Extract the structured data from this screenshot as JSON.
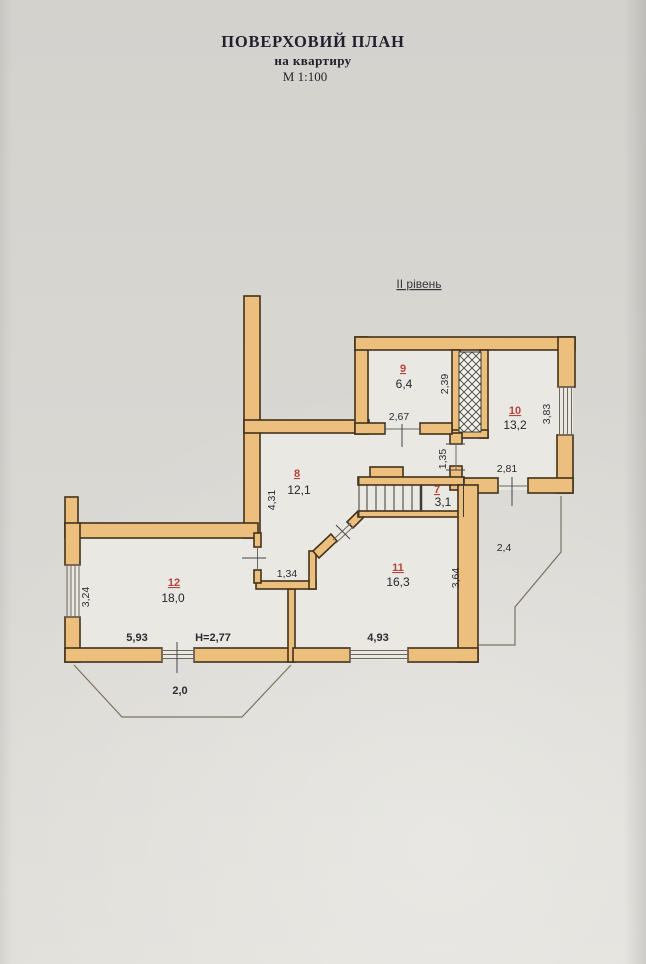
{
  "colors": {
    "paper": "#dad8d3",
    "floor": "#eae8e2",
    "wall_fill": "#ecc07c",
    "wall_stroke": "#42311d",
    "room_number_red": "#b5443c",
    "dim_text": "#2c2b33",
    "height_blue": "#2150b4",
    "title_ink": "#201f2b"
  },
  "title": {
    "line1": "ПОВЕРХОВИЙ ПЛАН",
    "line2": "на квартиру",
    "line3": "М 1:100"
  },
  "level_label": "ІІ рівень",
  "rooms": [
    {
      "number": "9",
      "area": "6,4"
    },
    {
      "number": "10",
      "area": "13,2"
    },
    {
      "number": "8",
      "area": "12,1"
    },
    {
      "number": "7",
      "area": "3,1"
    },
    {
      "number": "11",
      "area": "16,3"
    },
    {
      "number": "12",
      "area": "18,0"
    }
  ],
  "dims": {
    "room9_height": "2,39",
    "room9_width": "2,67",
    "opening_1_35": "1,35",
    "opening_2_81": "2,81",
    "room10_height": "3,83",
    "room8_height": "4,31",
    "room12_window": "3,24",
    "jog_1_34": "1,34",
    "room11_height": "3,64",
    "terrace_width": "2,4",
    "room12_width": "5,93",
    "room11_width": "4,93",
    "balcony_depth": "2,0",
    "ceiling_height": "H=2,77"
  }
}
